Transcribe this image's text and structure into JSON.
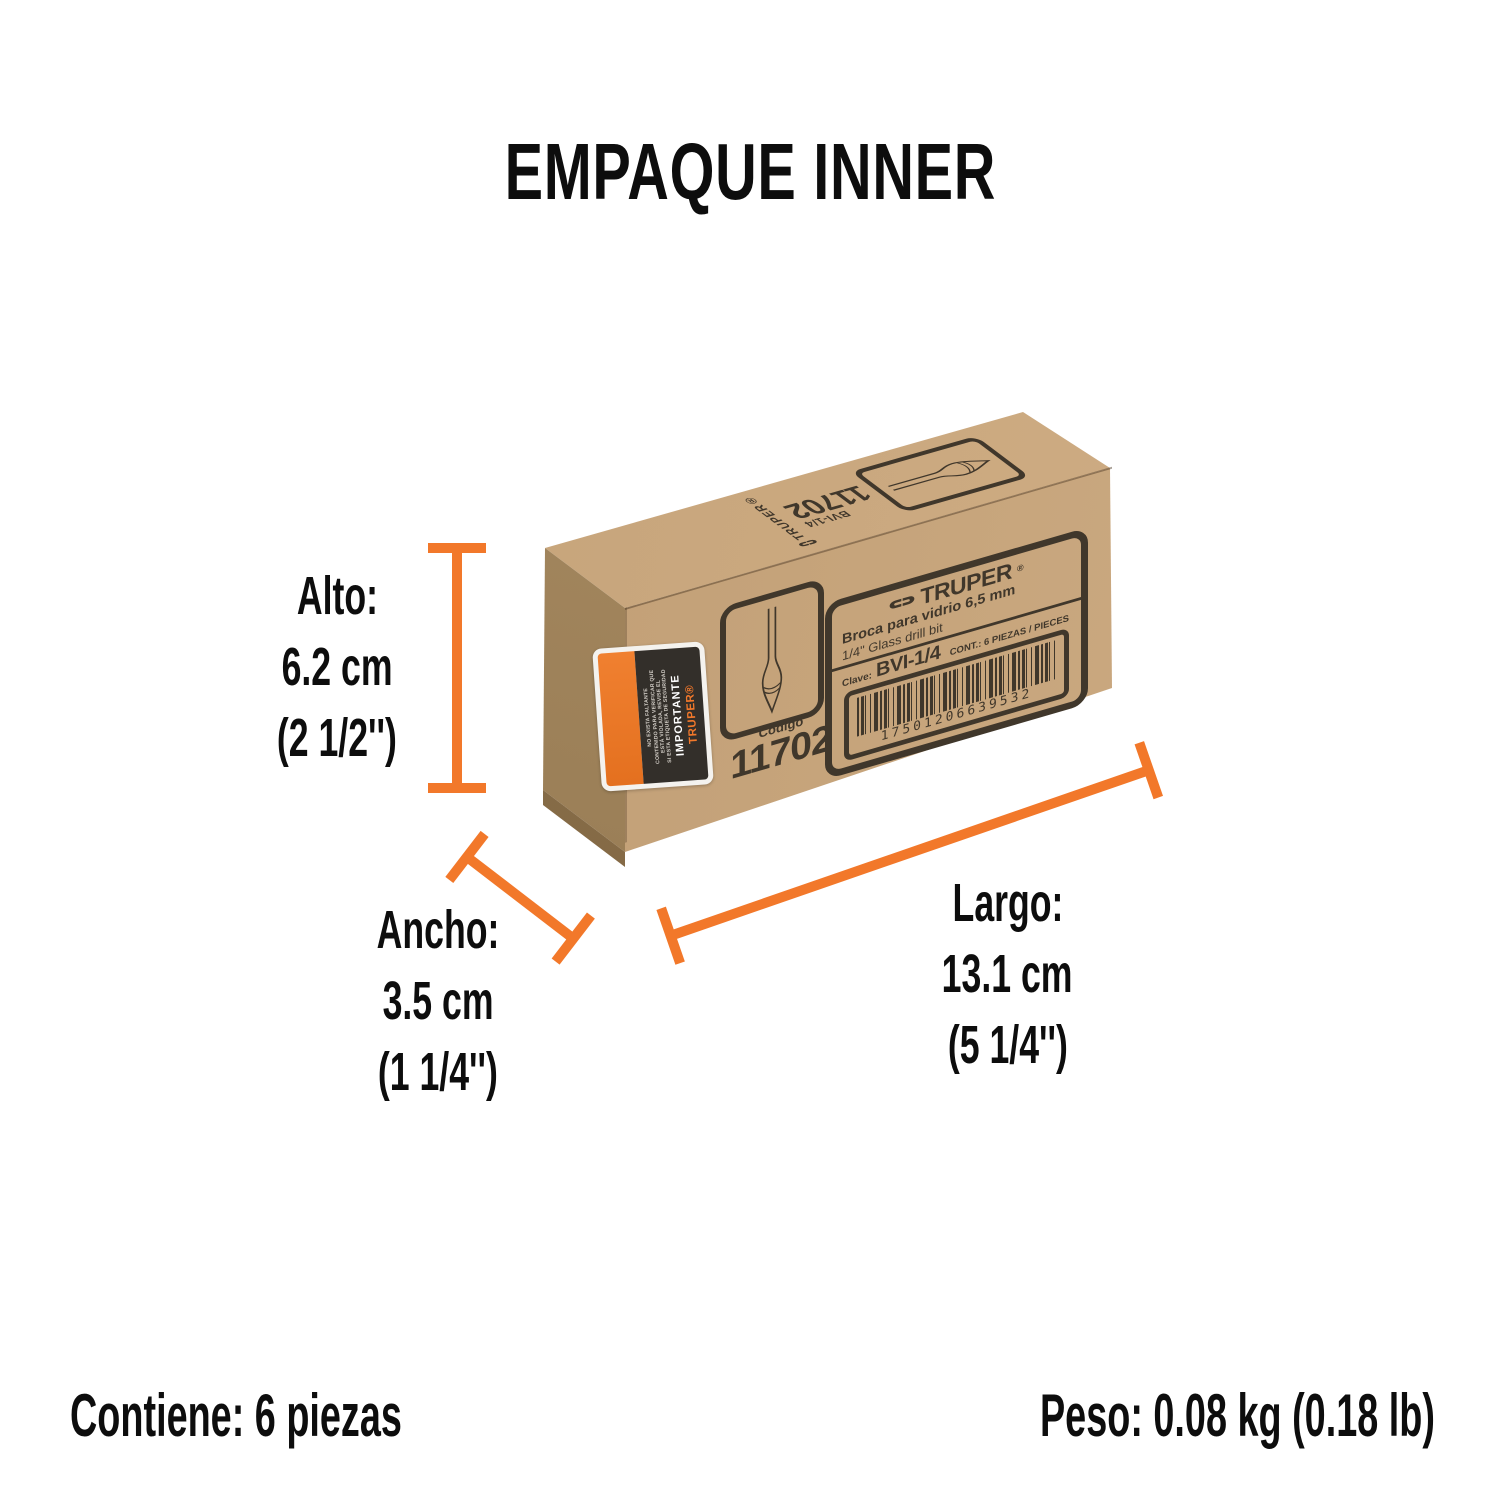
{
  "title": "EMPAQUE INNER",
  "accent_color": "#f2782a",
  "print_color": "#40372b",
  "dims": {
    "alto": {
      "label": "Alto:",
      "metric": "6.2 cm",
      "imperial": "(2 1/2'')"
    },
    "ancho": {
      "label": "Ancho:",
      "metric": "3.5 cm",
      "imperial": "(1 1/4'')"
    },
    "largo": {
      "label": "Largo:",
      "metric": "13.1 cm",
      "imperial": "(5 1/4'')"
    }
  },
  "footer": {
    "contains": "Contiene: 6 piezas",
    "weight_label": "Peso:",
    "weight_value": "0.08 kg (0.18 lb)"
  },
  "box": {
    "top_panel": {
      "brand": "TRUPER®",
      "code": "11702",
      "sku": "BVI-1/4"
    },
    "front_panel": {
      "brand": "TRUPER",
      "registered": "®",
      "product_es": "Broca para vidrio 6,5 mm",
      "product_en": "1/4\" Glass drill bit",
      "clave_label": "Clave:",
      "clave_value": "BVI-1/4",
      "content_note": "CONT.: 6 PIEZAS / PIECES",
      "barcode_digits": "17501206639532",
      "codigo_label": "Código",
      "codigo_value": "11702"
    },
    "security_label": {
      "brand": "TRUPER®",
      "heading": "IMPORTANTE",
      "line1": "SI ESTA ETIQUETA DE SEGURIDAD",
      "line2": "ESTÁ VIOLADA, REVISE EL",
      "line3": "CONTENIDO PARA VERIFICAR QUE",
      "line4": "NO EXISTA FALTANTE"
    }
  }
}
